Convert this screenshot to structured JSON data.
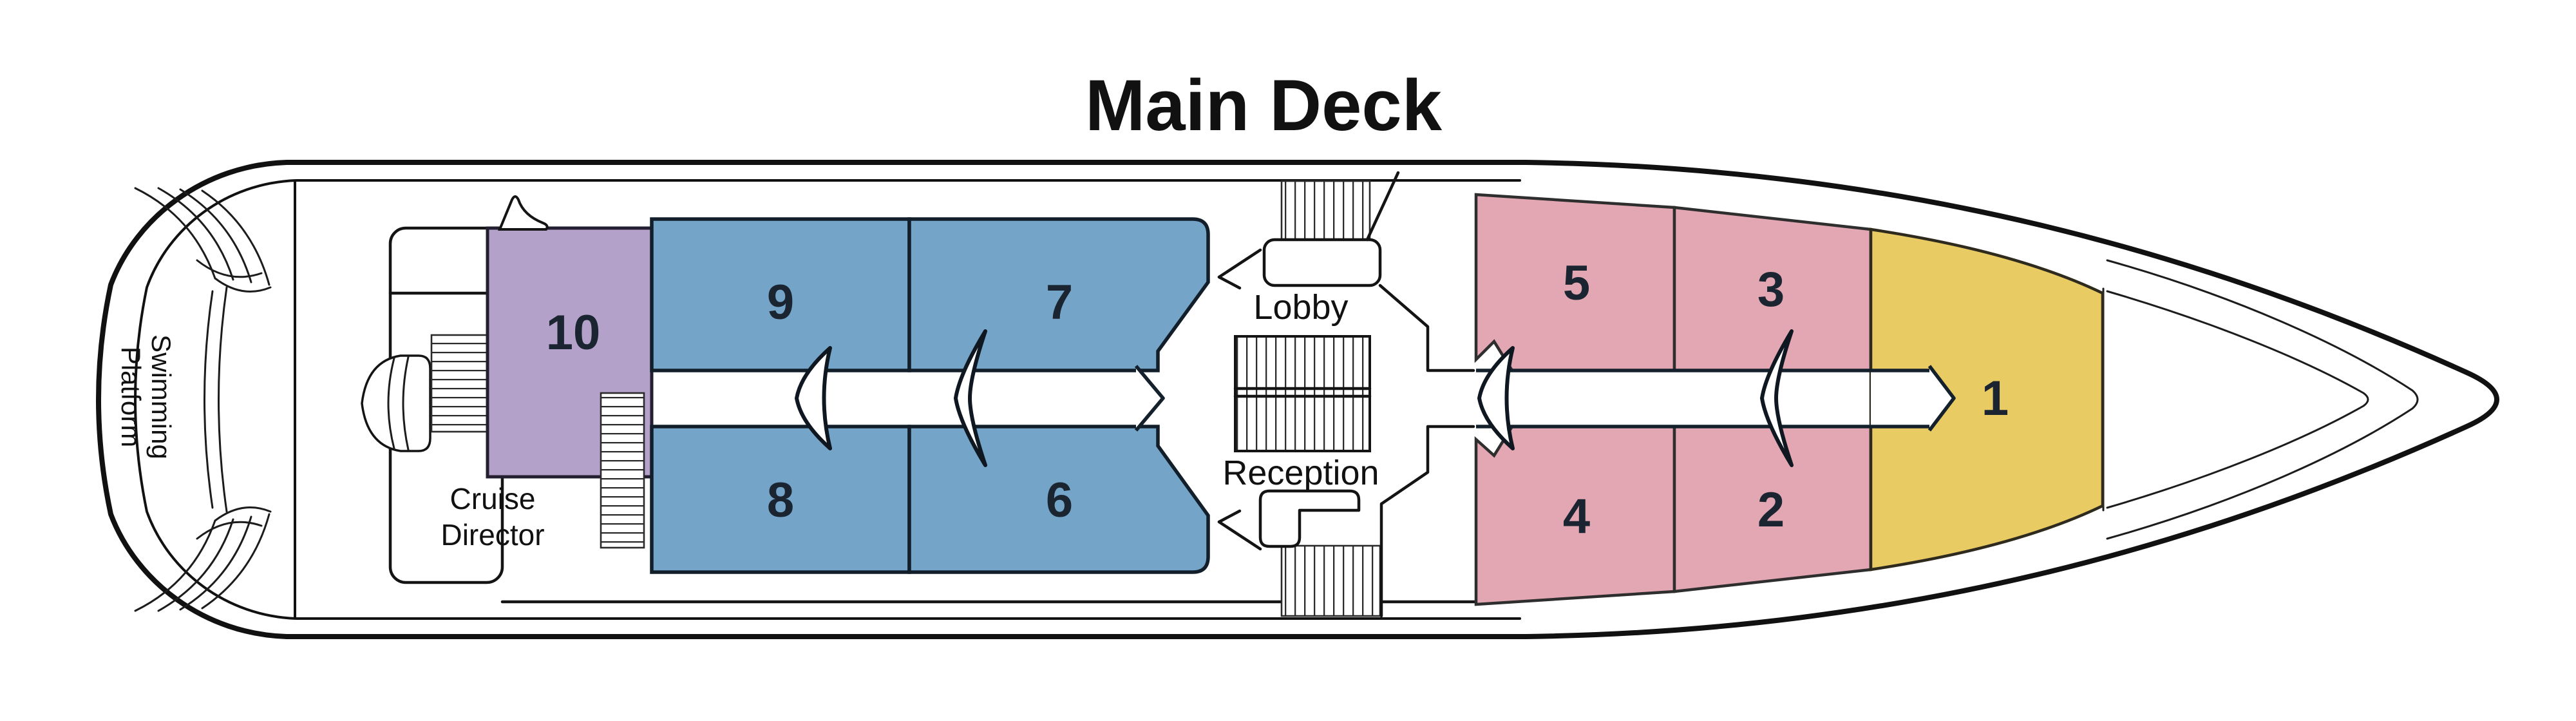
{
  "title": "Main Deck",
  "colors": {
    "purple": "#b4a1c9",
    "blue": "#74a5c8",
    "pink": "#e2a7b2",
    "yellow": "#e9cb63"
  },
  "labels": {
    "lobby": "Lobby",
    "reception": "Reception",
    "cruise_director": [
      "Cruise",
      "Director"
    ],
    "swimming_platform": [
      "Swimming",
      "Platform"
    ]
  },
  "cabins": {
    "c1": {
      "number": "1"
    },
    "c2": {
      "number": "2"
    },
    "c3": {
      "number": "3"
    },
    "c4": {
      "number": "4"
    },
    "c5": {
      "number": "5"
    },
    "c6": {
      "number": "6"
    },
    "c7": {
      "number": "7"
    },
    "c8": {
      "number": "8"
    },
    "c9": {
      "number": "9"
    },
    "c10": {
      "number": "10"
    }
  }
}
